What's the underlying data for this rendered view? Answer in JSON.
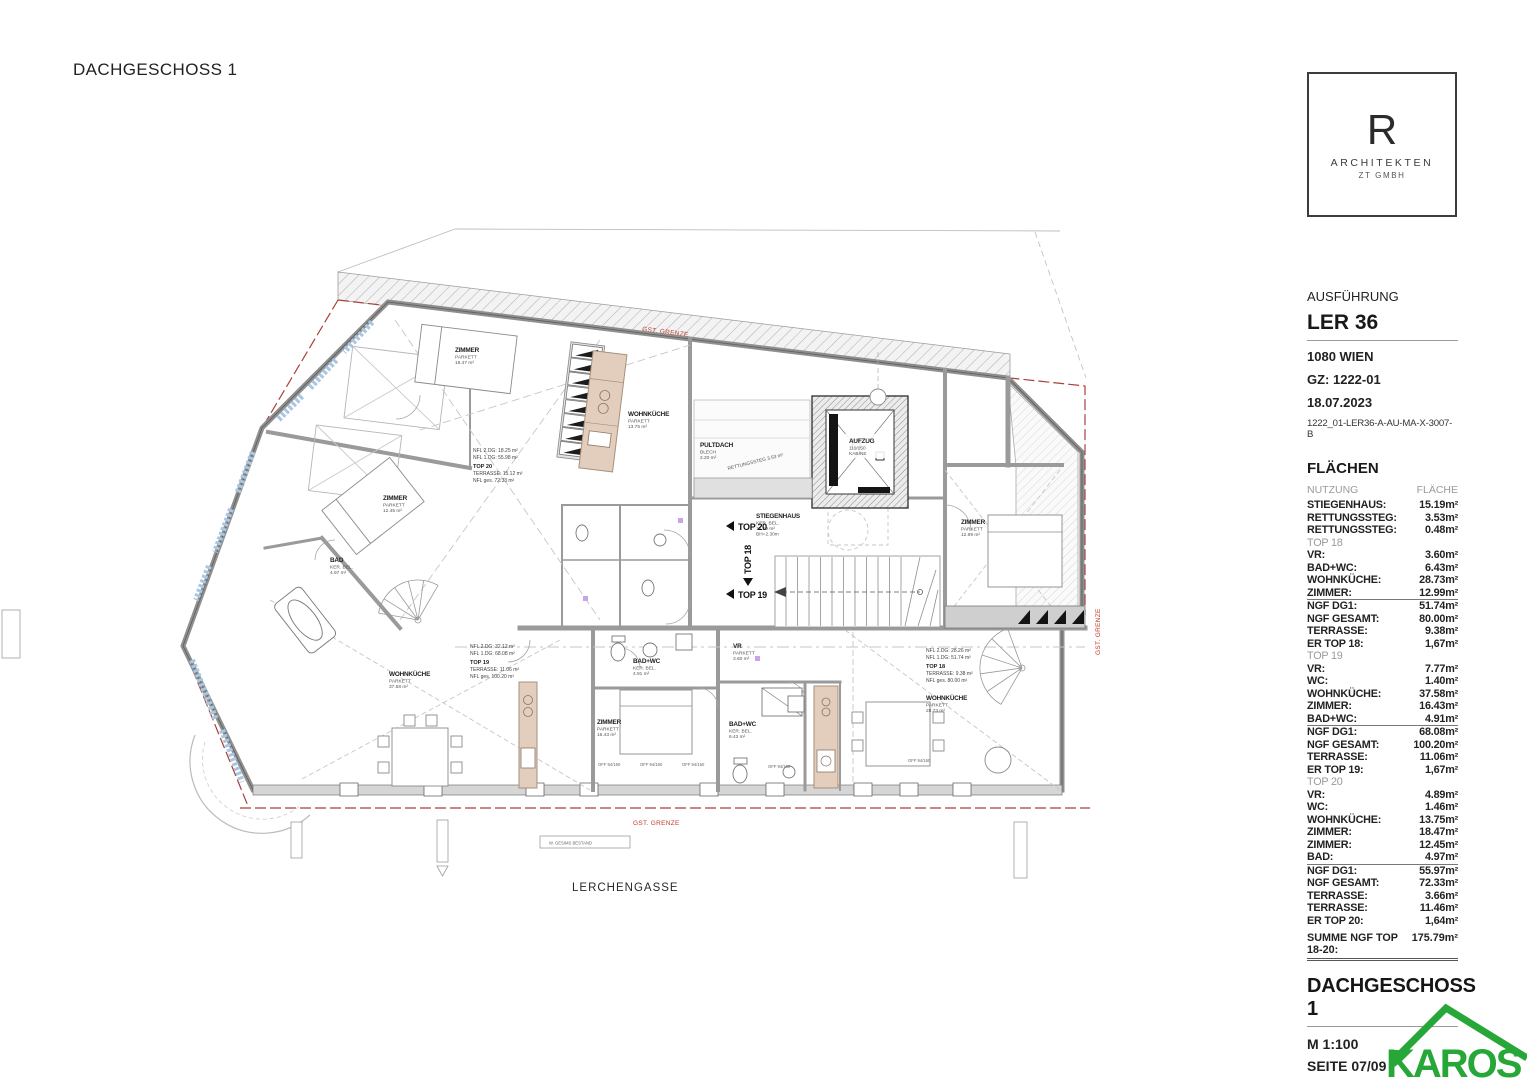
{
  "document": {
    "heading": "DACHGESCHOSS 1"
  },
  "plan": {
    "street": "LERCHENGASSE",
    "boundary_label": "GST. GRENZE",
    "gesims_label": "W. GESIMS BESTAND",
    "window_spec": "OFF 94/160",
    "entries": {
      "top20": "TOP 20",
      "top19": "TOP 19",
      "top18": "TOP 18"
    },
    "core": {
      "stiegenhaus": [
        "STIEGENHAUS",
        "KER. BEL.",
        "15.19 m²",
        "BH=2.30m"
      ],
      "aufzug": [
        "AUFZUG",
        "111/150",
        "KABINE"
      ],
      "pultdach": [
        "PULTDACH",
        "BLECH",
        "2.20 m²"
      ],
      "rettungssteg": "RETTUNGSSTEG 3.53 m²"
    },
    "rooms": [
      {
        "name": "ZIMMER",
        "finish": "PARKETT",
        "area": "18.47 m²"
      },
      {
        "name": "ZIMMER",
        "finish": "PARKETT",
        "area": "12.45 m²"
      },
      {
        "name": "BAD",
        "finish": "KER. BEL.",
        "area": "4.97 m²"
      },
      {
        "name": "WOHNKÜCHE",
        "finish": "PARKETT",
        "area": "13.75 m²"
      },
      {
        "name": "WOHNKÜCHE",
        "finish": "PARKETT",
        "area": "37.58 m²"
      },
      {
        "name": "ZIMMER",
        "finish": "PARKETT",
        "area": "16.43 m²"
      },
      {
        "name": "BAD+WC",
        "finish": "KER. BEL.",
        "area": "4.91 m²"
      },
      {
        "name": "VR",
        "finish": "PARKETT",
        "area": "3.60 m²"
      },
      {
        "name": "BAD+WC",
        "finish": "KER. BEL.",
        "area": "6.43 m²"
      },
      {
        "name": "WOHNKÜCHE",
        "finish": "PARKETT",
        "area": "28.73 m²"
      },
      {
        "name": "ZIMMER",
        "finish": "PARKETT",
        "area": "12.99 m²"
      }
    ],
    "notes": [
      {
        "lines": [
          "NFL 2.DG: 18.25 m²",
          "NFL 1.DG: 55.98 m²",
          "TOP 20",
          "TERRASSE: 15.12 m²",
          "NFL ges. 72.33 m²"
        ]
      },
      {
        "lines": [
          "NFL 2.DG: 32.12 m²",
          "NFL 1.DG: 68.08 m²",
          "TOP 19",
          "TERRASSE: 11.06 m²",
          "NFL ges. 100.20 m²"
        ]
      },
      {
        "lines": [
          "NFL 2.DG: 28.26 m²",
          "NFL 1.DG: 51.74 m²",
          "TOP 18",
          "TERRASSE: 9.38 m²",
          "NFL ges. 80.00 m²"
        ]
      }
    ]
  },
  "titleblock": {
    "logo": {
      "letter": "R",
      "line1": "ARCHITEKTEN",
      "line2": "ZT GMBH"
    },
    "phase": "AUSFÜHRUNG",
    "project": "LER 36",
    "city": "1080 WIEN",
    "gz": "GZ: 1222-01",
    "date": "18.07.2023",
    "doc_no": "1222_01-LER36-A-AU-MA-X-3007-B",
    "areas_heading": "FLÄCHEN",
    "columns": {
      "nutzung": "NUTZUNG",
      "flaeche": "FLÄCHE"
    },
    "rows": [
      {
        "label": "STIEGENHAUS:",
        "value": "15.19m²"
      },
      {
        "label": "RETTUNGSSTEG:",
        "value": "3.53m²"
      },
      {
        "label": "RETTUNGSSTEG:",
        "value": "0.48m²"
      },
      {
        "label": "TOP 18",
        "value": "",
        "type": "section"
      },
      {
        "label": "VR:",
        "value": "3.60m²"
      },
      {
        "label": "BAD+WC:",
        "value": "6.43m²"
      },
      {
        "label": "WOHNKÜCHE:",
        "value": "28.73m²"
      },
      {
        "label": "ZIMMER:",
        "value": "12.99m²",
        "type": "rule"
      },
      {
        "label": "NGF DG1:",
        "value": "51.74m²"
      },
      {
        "label": "NGF GESAMT:",
        "value": "80.00m²"
      },
      {
        "label": "TERRASSE:",
        "value": "9.38m²"
      },
      {
        "label": "ER TOP 18:",
        "value": "1,67m²"
      },
      {
        "label": "TOP 19",
        "value": "",
        "type": "section"
      },
      {
        "label": "VR:",
        "value": "7.77m²"
      },
      {
        "label": "WC:",
        "value": "1.40m²"
      },
      {
        "label": "WOHNKÜCHE:",
        "value": "37.58m²"
      },
      {
        "label": "ZIMMER:",
        "value": "16.43m²"
      },
      {
        "label": "BAD+WC:",
        "value": "4.91m²",
        "type": "rule"
      },
      {
        "label": "NGF DG1:",
        "value": "68.08m²"
      },
      {
        "label": "NGF GESAMT:",
        "value": "100.20m²"
      },
      {
        "label": "TERRASSE:",
        "value": "11.06m²"
      },
      {
        "label": "ER TOP 19:",
        "value": "1,67m²"
      },
      {
        "label": "TOP 20",
        "value": "",
        "type": "section"
      },
      {
        "label": "VR:",
        "value": "4.89m²"
      },
      {
        "label": "WC:",
        "value": "1.46m²"
      },
      {
        "label": "WOHNKÜCHE:",
        "value": "13.75m²"
      },
      {
        "label": "ZIMMER:",
        "value": "18.47m²"
      },
      {
        "label": "ZIMMER:",
        "value": "12.45m²"
      },
      {
        "label": "BAD:",
        "value": "4.97m²",
        "type": "rule"
      },
      {
        "label": "NGF DG1:",
        "value": "55.97m²"
      },
      {
        "label": "NGF GESAMT:",
        "value": "72.33m²"
      },
      {
        "label": "TERRASSE:",
        "value": "3.66m²"
      },
      {
        "label": "TERRASSE:",
        "value": "11.46m²"
      },
      {
        "label": "ER TOP 20:",
        "value": "1,64m²"
      }
    ],
    "sum": {
      "label": "SUMME NGF TOP 18-20:",
      "value": "175.79m²"
    },
    "sheet_title": "DACHGESCHOSS 1",
    "scale": "M 1:100",
    "page": "SEITE 07/09",
    "copyright_bold": "© RIEDL + PARTNER",
    "copyright_rest": " Architekten ZT GmbH"
  },
  "branding": {
    "karos": "KAROS",
    "green": "#27a737"
  },
  "colors": {
    "boundary_red": "#a84238",
    "label_red": "#c0392b",
    "kitchen_tan": "#e3cdbd",
    "window_blue": "#a9c7e2",
    "wall_gray": "#8f8f8f"
  }
}
